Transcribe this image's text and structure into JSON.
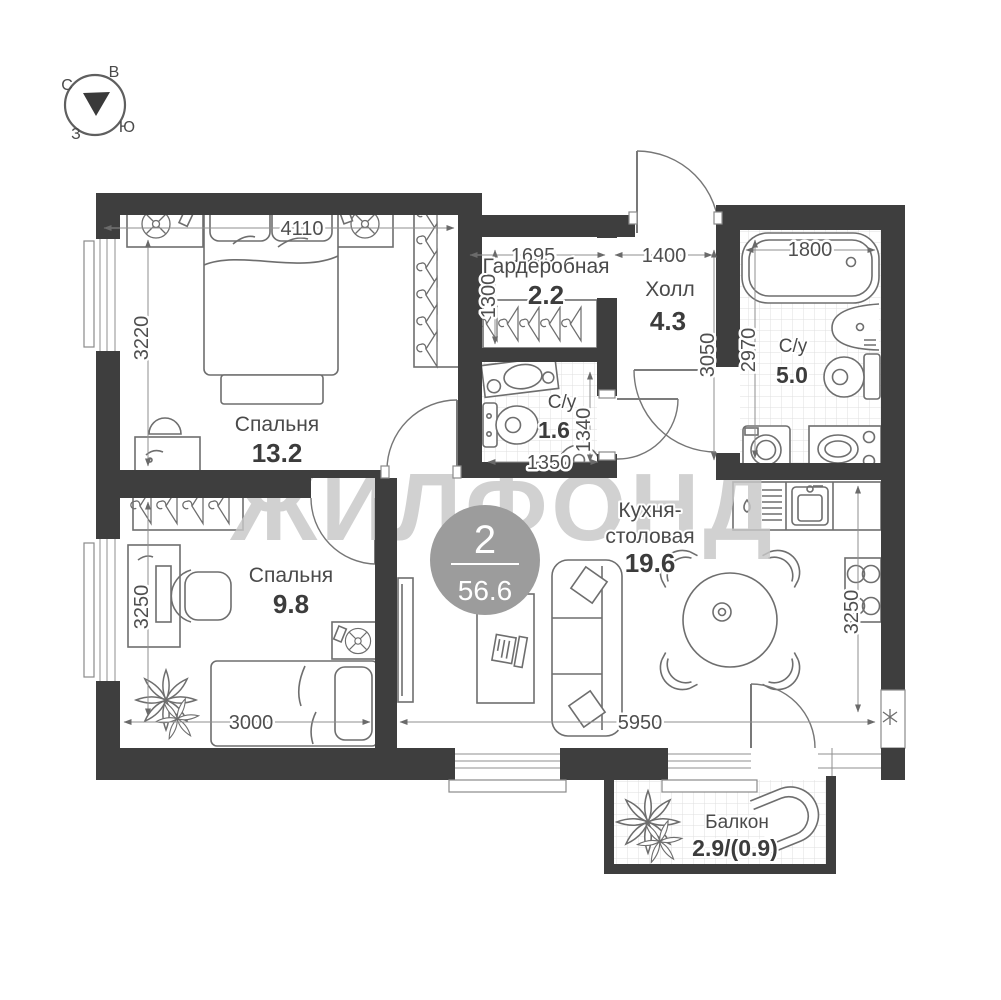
{
  "colors": {
    "wall": "#3e3e3e",
    "furniture_line": "#6e6e6e",
    "dimension_text": "#4f4f4f",
    "label_text": "#4a4a4a",
    "watermark": "#c7c7c7",
    "badge_background": "#9c9c9c",
    "tile_grid": "#dfdfdf"
  },
  "compass": {
    "north": "С",
    "east": "В",
    "west": "З",
    "south": "Ю"
  },
  "watermark": "ЖИЛФОНД",
  "badge": {
    "rooms_count": "2",
    "total_area": "56.6"
  },
  "rooms": {
    "bedroom1": {
      "name": "Спальня",
      "area": "13.2"
    },
    "bedroom2": {
      "name": "Спальня",
      "area": "9.8"
    },
    "wardrobe": {
      "name": "Гардеробная",
      "area": "2.2"
    },
    "hall": {
      "name": "Холл",
      "area": "4.3"
    },
    "bathroom_small": {
      "name": "С/у",
      "area": "1.6"
    },
    "bathroom_large": {
      "name": "С/у",
      "area": "5.0"
    },
    "kitchen": {
      "name_line1": "Кухня-",
      "name_line2": "столовая",
      "area": "19.6"
    },
    "balcony": {
      "name": "Балкон",
      "area": "2.9/(0.9)"
    }
  },
  "dimensions_mm": {
    "bedroom1_width": "4110",
    "bedroom1_depth": "3220",
    "wardrobe_width": "1695",
    "wardrobe_depth": "1300",
    "hall_width": "1400",
    "hall_depth": "3050",
    "bathroom_large_width": "1800",
    "bathroom_large_depth": "2970",
    "bathroom_small_width": "1350",
    "bathroom_small_depth": "1340",
    "bedroom2_width": "3000",
    "bedroom2_depth": "3250",
    "kitchen_width": "5950",
    "kitchen_depth": "3250"
  }
}
